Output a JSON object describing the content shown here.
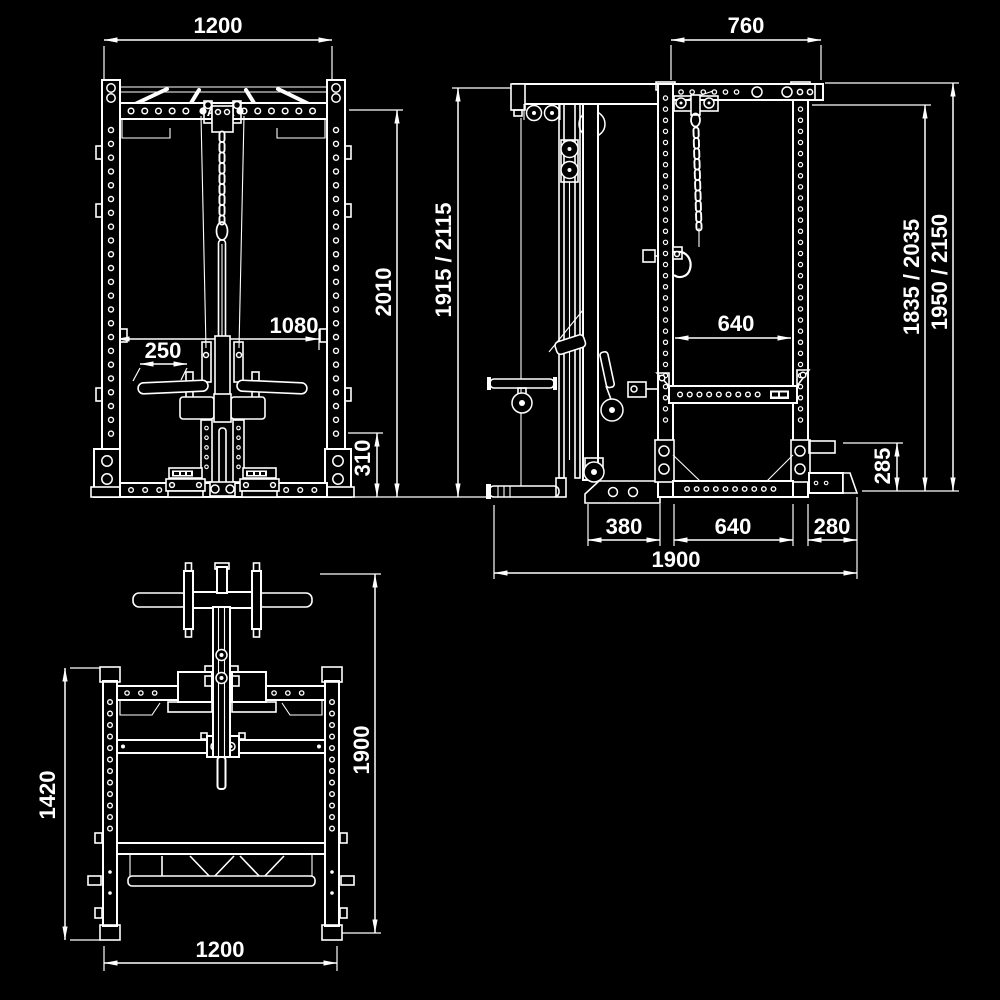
{
  "canvas": {
    "background": "#000000",
    "line_color": "#ffffff"
  },
  "brand": {
    "logo": "ATX"
  },
  "views": {
    "front": {
      "dims": {
        "top_width": "1200",
        "inner_width": "1080",
        "grip_length": "250",
        "inner_height": "2010",
        "base_height": "310"
      }
    },
    "side": {
      "dims": {
        "top_depth": "760",
        "total_height": "1915 / 2115",
        "rear_inner_height": "1835 / 2035",
        "rear_outer_height": "1950 / 2150",
        "safety_bar_span": "640",
        "rear_foot_height": "285",
        "front_foot_depth": "380",
        "bottom_inner_depth": "640",
        "rear_overhang": "280",
        "total_depth": "1900"
      }
    },
    "top": {
      "dims": {
        "side_rail_depth": "1420",
        "total_depth": "1900",
        "width": "1200"
      }
    }
  }
}
